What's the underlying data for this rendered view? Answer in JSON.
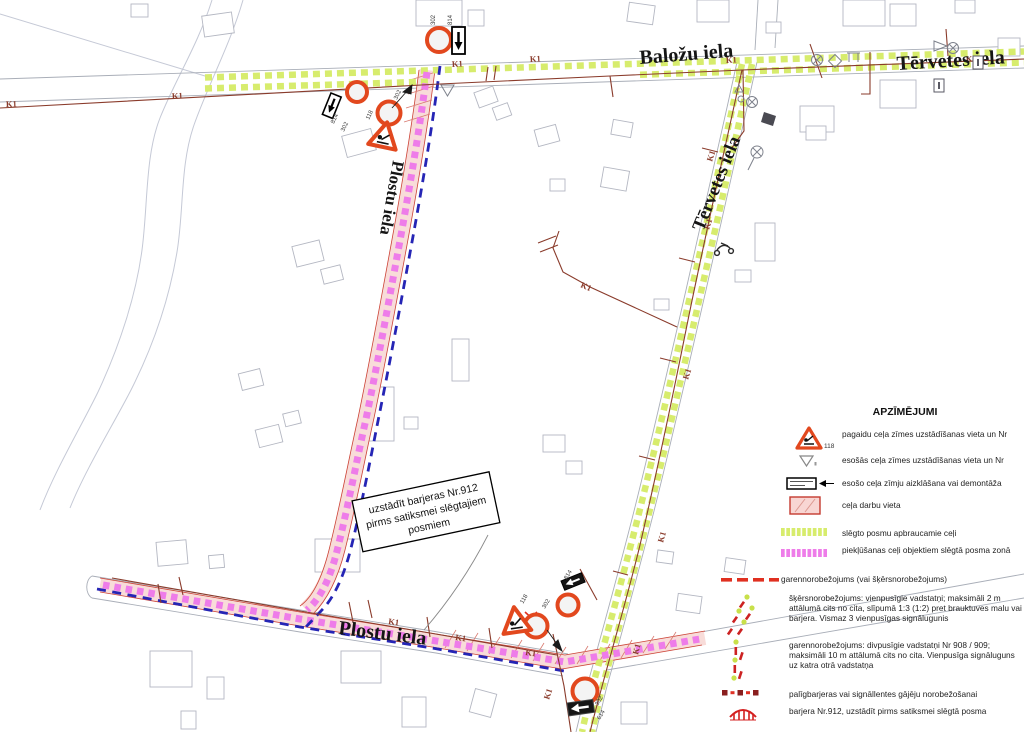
{
  "map": {
    "streets": {
      "balozu_top": "Baložu iela",
      "tervetes_top": "Tērvetes iela",
      "tervetes_vertical": "Tērvetes iela",
      "plostu_vertical": "Plostu iela",
      "plostu_bottom": "Plostu iela"
    },
    "note_box": {
      "lines": [
        "uzstādīt barjeras Nr.912",
        "pirms satiksmei slēgtajiem",
        "posmiem"
      ]
    },
    "labels": {
      "k1": "K1",
      "sign_302": "302",
      "sign_814": "814",
      "sign_118": "118",
      "sign_614": "614"
    }
  },
  "legend": {
    "title": "APZĪMĒJUMI",
    "items": [
      {
        "icon": "roadworks-sign-icon",
        "badge": "118",
        "text": "pagaidu ceļa zīmes uzstādīšanas vieta un Nr"
      },
      {
        "icon": "existing-sign-triangle-icon",
        "text": "esošās ceļa zīmes uzstādīšanas vieta un Nr"
      },
      {
        "icon": "covered-sign-icon",
        "text": "esošo ceļa zīmju aizklāšana vai demontāža"
      },
      {
        "icon": "work-zone-icon",
        "text": "ceļa darbu vieta"
      },
      {
        "icon": "detour-route-icon",
        "text": "slēgto posmu apbraucamie ceļi"
      },
      {
        "icon": "access-route-icon",
        "text": "piekļūšanas ceļi objektiem slēgtā posma zonā"
      },
      {
        "icon": "longitudinal-limit-icon",
        "text": "garennorobežojums (vai šķērsnorobežojums)"
      },
      {
        "icon": "cross-limit-posts-icon",
        "text": "šķērsnorobežojums: vienpusīgie vadstatņi; maksimāli 2 m attālumā cits no cita, slīpumā 1:3 (1:2) pret brauktuves malu vai barjera. Vismaz 3 vienpusīgas signālugunis"
      },
      {
        "icon": "longitudinal-posts-icon",
        "text": "garennorobežojums: divpusīgie vadstatņi Nr 908 / 909; maksimāli 10 m attālumā cits no cita. Vienpusīga signāluguns uz katra otrā vadstatņa"
      },
      {
        "icon": "pedestrian-barrier-icon",
        "text": "palīgbarjeras vai signāllentes gājēju norobežošanai"
      },
      {
        "icon": "barrier-912-icon",
        "text": "barjera Nr.912, uzstādīt pirms satiksmei slēgtā posma"
      }
    ]
  },
  "colors": {
    "detour_green": "#d7ec6d",
    "access_magenta": "#ee7ce9",
    "work_zone_pink": "#f8dcd9",
    "work_zone_border": "#cc4337",
    "closure_blue": "#2525b5",
    "utility_line": "#8a3b2b",
    "temp_sign_red": "#e2481e"
  }
}
